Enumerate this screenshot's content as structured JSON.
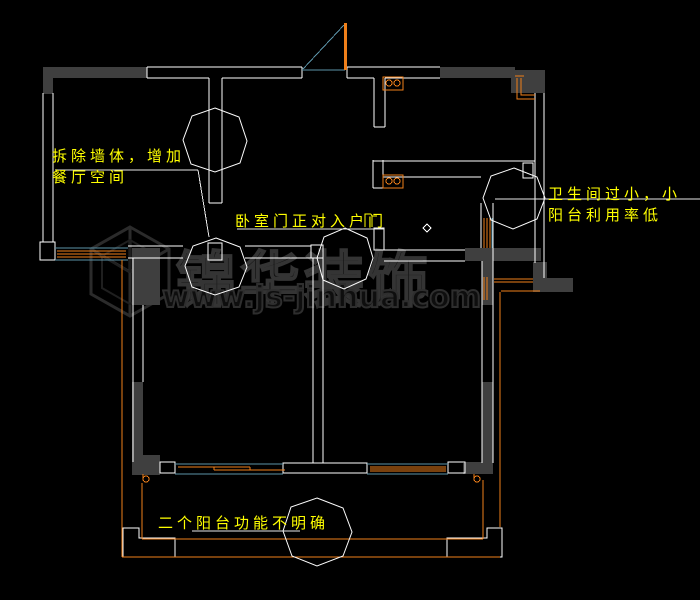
{
  "drawing": {
    "type": "apartment floor plan markup (CAD screenshot)",
    "background": "#000000"
  },
  "annotations": [
    {
      "id": "demolish-wall",
      "text": "拆除墙体，增加餐厅空间"
    },
    {
      "id": "bedroom-door",
      "text": "卧室门正对入户门"
    },
    {
      "id": "bathroom-small",
      "text": "卫生间过小，小阳台利用率低"
    },
    {
      "id": "balcony-function",
      "text": "二个阳台功能不明确"
    }
  ],
  "watermark": {
    "brand": "锦华装饰",
    "url": "www.js-jinhua.com"
  },
  "symbols": [
    "revision-cloud",
    "door-swing",
    "sliding-window",
    "wall-fill",
    "floor-drain-diamond",
    "rain-pipe",
    "stove-outlet"
  ],
  "colors": {
    "background": "#000000",
    "wall_line": "#ffffff",
    "wall_fill": "#3f3f3f",
    "window_frame": "#ef7f1a",
    "window_glass": "#5b93a8",
    "annotation_text": "#ffff00",
    "revision_cloud": "#fdfdfd",
    "watermark": "#2e2e2e"
  }
}
